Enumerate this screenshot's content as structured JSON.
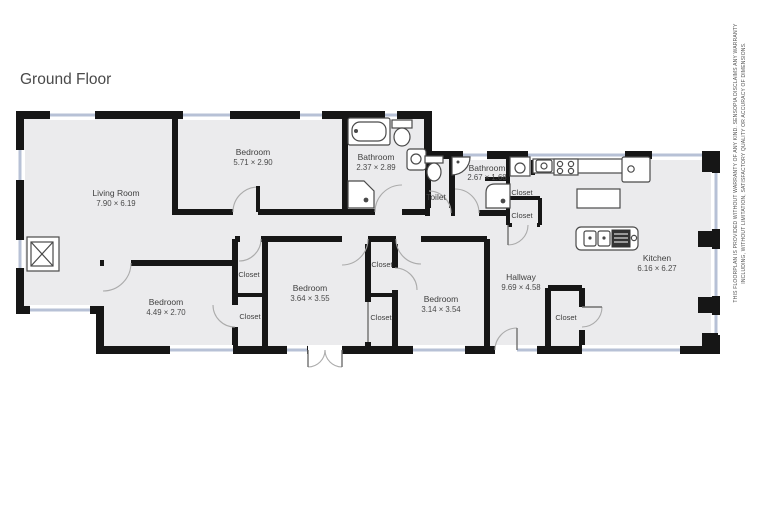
{
  "title": "Ground Floor",
  "rooms": {
    "living_room": {
      "name": "Living Room",
      "dims": "7.90 × 6.19"
    },
    "bedroom_top": {
      "name": "Bedroom",
      "dims": "5.71 × 2.90"
    },
    "bathroom_main": {
      "name": "Bathroom",
      "dims": "2.37 × 2.89"
    },
    "toilet": {
      "name": "Toilet"
    },
    "bathroom_small": {
      "name": "Bathroom",
      "dims": "2.67 × 1.68"
    },
    "bedroom_left": {
      "name": "Bedroom",
      "dims": "4.49 × 2.70"
    },
    "bedroom_middle": {
      "name": "Bedroom",
      "dims": "3.64 × 3.55"
    },
    "bedroom_right": {
      "name": "Bedroom",
      "dims": "3.14 × 3.54"
    },
    "hallway": {
      "name": "Hallway",
      "dims": "9.69 × 4.58"
    },
    "kitchen": {
      "name": "Kitchen",
      "dims": "6.16 × 6.27"
    }
  },
  "closets": [
    {
      "label": "Closet"
    },
    {
      "label": "Closet"
    },
    {
      "label": "Closet"
    },
    {
      "label": "Closet"
    },
    {
      "label": "Closet"
    },
    {
      "label": "Closet"
    },
    {
      "label": "Closet"
    }
  ],
  "fixtures": {
    "fireplace": "fireplace",
    "bathtub": "bathtub",
    "toilet_main": "toilet",
    "sink_main": "sink",
    "shower_main": "corner-shower",
    "toilet_small": "toilet",
    "sink_small": "corner-sink",
    "shower_small": "shower",
    "washer": "washing-machine",
    "stove": "cooktop",
    "kitchen_sink": "sink",
    "island": "kitchen-island",
    "island_sink_stove": "island-with-sink-and-cooktop",
    "fridge": "appliance"
  },
  "disclaimer": {
    "line1": "THIS FLOORPLAN IS PROVIDED WITHOUT WARRANTY OF ANY KIND. SENSOPIA DISCLAIMS ANY WARRANTY",
    "line2": "INCLUDING, WITHOUT LIMITATION, SATISFACTORY QUALITY OR ACCURACY OF DIMENSIONS."
  },
  "colors": {
    "wall": "#161616",
    "floor": "#ebebed",
    "window": "#b7c1d6",
    "background": "#ffffff",
    "text": "#3f3f3f"
  }
}
